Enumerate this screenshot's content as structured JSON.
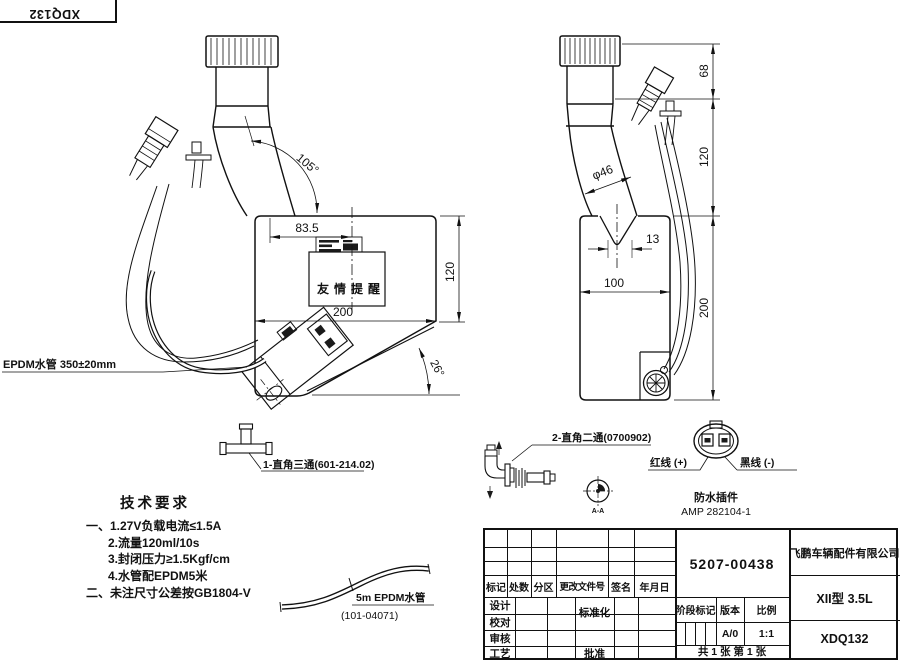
{
  "sheet": {
    "corner_stamp": "XDQ132"
  },
  "front_view": {
    "dim_width_top": "83.5",
    "dim_angle_neck": "105°",
    "dim_height_right": "120",
    "dim_width_bottom": "200",
    "dim_angle_bottom": "26°",
    "reminder_label": "友情提醒",
    "hose_label": "EPDM水管 350±20mm"
  },
  "side_view": {
    "dim_neck_dia": "φ46",
    "dim_top": "68",
    "dim_mid": "120",
    "dim_height": "200",
    "dim_offset": "13",
    "dim_width": "100"
  },
  "details": {
    "tee_label": "1-直角三通(601-214.02)",
    "elbow_label": "2-直角二通(0700902)",
    "section_mark": "A-A",
    "red_wire": "红线 (+)",
    "black_wire": "黑线 (-)",
    "connector_name": "防水插件",
    "connector_model": "AMP 282104-1",
    "hose5m_label": "5m  EPDM水管",
    "hose5m_code": "(101-04071)"
  },
  "tech_requirements": {
    "title": "技术要求",
    "items": [
      "一、1.27V负载电流≤1.5A",
      "2.流量120ml/10s",
      "3.封闭压力≥1.5Kgf/cm",
      "4.水管配EPDM5米",
      "二、未注尺寸公差按GB1804-V"
    ]
  },
  "title_block": {
    "drawing_no": "5207-00438",
    "company": "飞鹏车辆配件有限公司",
    "model": "XII型 3.5L",
    "part_no": "XDQ132",
    "rev_headers": [
      "标记",
      "处数",
      "分区",
      "更改文件号",
      "签名",
      "年月日"
    ],
    "sig_rows": [
      "设计",
      "校对",
      "审核",
      "工艺"
    ],
    "standardization": "标准化",
    "approve": "批准",
    "stage_header": "阶段标记",
    "version_header": "版本",
    "scale_header": "比例",
    "version": "A/0",
    "scale": "1:1",
    "sheet_info": "共 1 张  第 1 张"
  }
}
